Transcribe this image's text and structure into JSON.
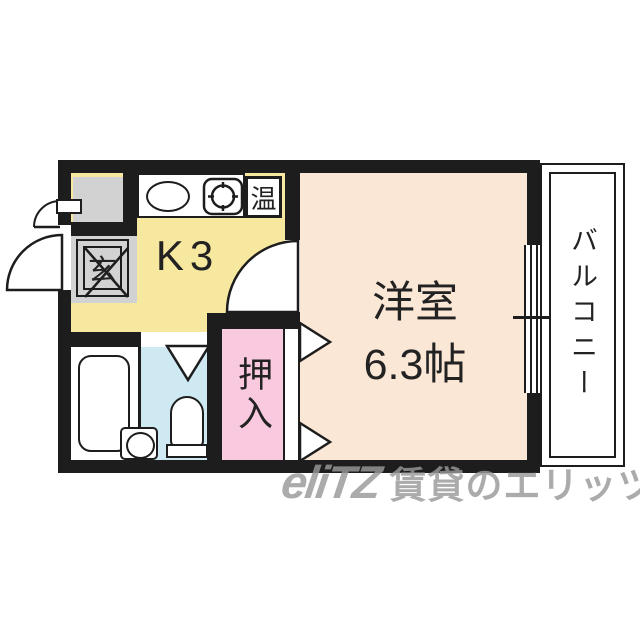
{
  "colors": {
    "wall": "#1d1d1d",
    "kitchen_fill": "#f7e8a0",
    "main_room_fill": "#fbe7d5",
    "closet_fill": "#f8c9df",
    "bath_fill": "#cfe9f3",
    "entrance_fill": "#d2d2d2",
    "watermark_gray": "#999999"
  },
  "floorplan": {
    "kitchen": {
      "label": "K3"
    },
    "entrance": {
      "label": "玄"
    },
    "water_heater": {
      "label": "温"
    },
    "main_room": {
      "name": "洋室",
      "size": "6.3帖"
    },
    "closet": {
      "label": "押入"
    },
    "balcony": {
      "label": "バルコニー"
    }
  },
  "watermark": {
    "logo": "eliTZ",
    "text": "賃貸のエリッツ"
  }
}
